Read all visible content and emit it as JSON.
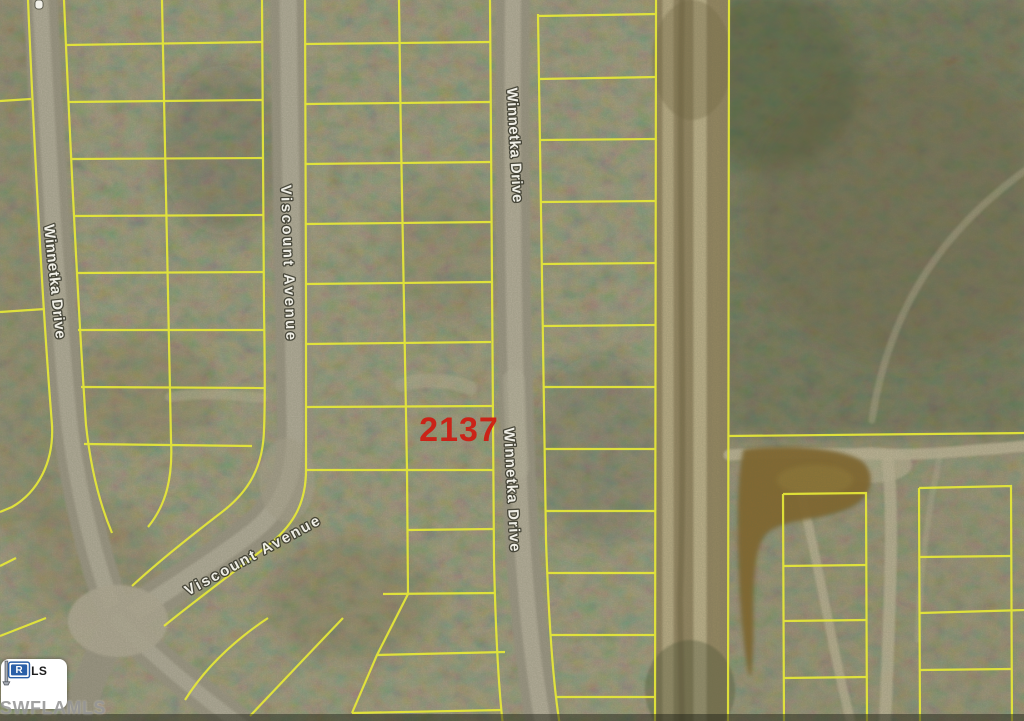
{
  "photo": {
    "parcel_number": "2137",
    "streets": {
      "winnetka_left": "Winnetka Drive",
      "viscount_upper": "Viscount Avenue",
      "winnetka_upper": "Winnetka Drive",
      "winnetka_lower": "Winnetka Drive",
      "viscount_lower": "Viscount Avenue"
    },
    "watermark": {
      "logo": "MLS",
      "org": "SWFLAMLS",
      "flag_letter": "R"
    },
    "colors": {
      "parcel_line": "#e6e838",
      "parcel_number_red": "#cf1a10",
      "street_label": "#f2f1e9",
      "mls_blue": "#2b5fa7",
      "watermark_gray": "#969696"
    }
  }
}
